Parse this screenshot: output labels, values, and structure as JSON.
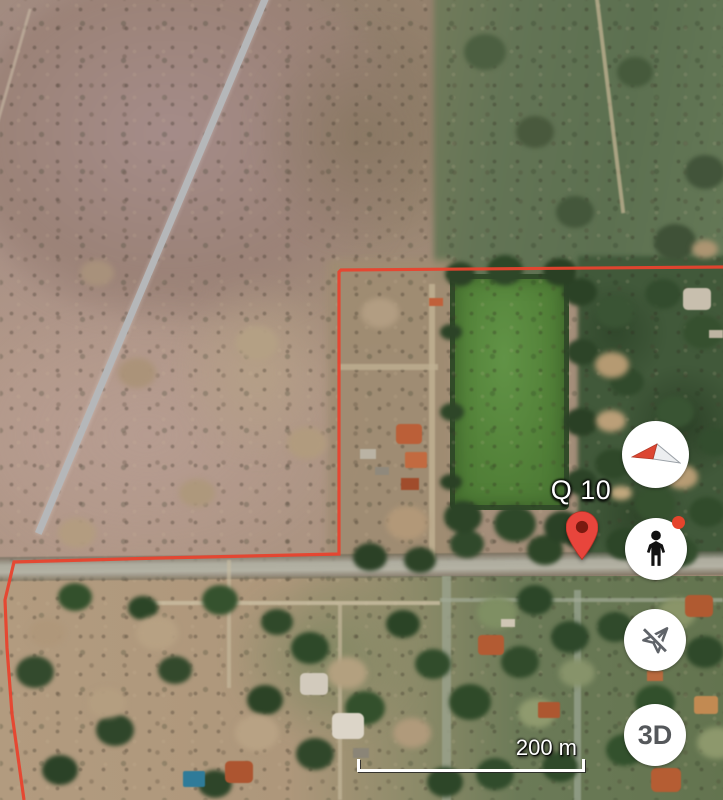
{
  "app": {
    "name": "satellite-map-view"
  },
  "map": {
    "pin": {
      "label": "Q 10",
      "color": "#e8453c",
      "inner_color": "#7a1a10"
    },
    "boundary": {
      "color": "#e8432e"
    },
    "scale_bar": {
      "label": "200 m"
    }
  },
  "controls": [
    {
      "id": "compass",
      "icon": "compass-needle-icon"
    },
    {
      "id": "street-view",
      "icon": "pegman-icon",
      "badge_color": "#e5442c"
    },
    {
      "id": "flight-off",
      "icon": "plane-crossed-icon"
    },
    {
      "id": "three-d",
      "label": "3D"
    }
  ]
}
